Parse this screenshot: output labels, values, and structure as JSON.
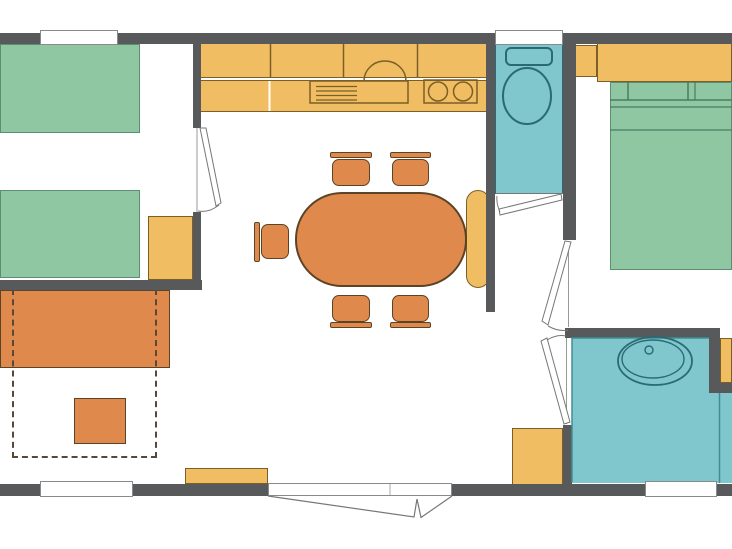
{
  "meta": {
    "title": "mobile-home-floor-plan",
    "canvas": {
      "w": 732,
      "h": 549
    }
  },
  "colors": {
    "background": "#ffffff",
    "wall": "#58595b",
    "window_border": "#8a8a8a",
    "bed_fill": "#8fc7a3",
    "bed_border": "#5d8e74",
    "bed_line": "#4a7b62",
    "water_fill": "#80c6cd",
    "water_border": "#2a6a74",
    "water_line": "#3f8d96",
    "cabinet_fill": "#f0bd62",
    "cabinet_border": "#8a6b2b",
    "cabinet_line": "#7b5f26",
    "orange_fill": "#e0894c",
    "orange_border": "#5b4426",
    "dash_border": "#55493c",
    "door_line": "#777777",
    "door_frame": "#999999"
  },
  "rooms": [
    {
      "name": "twin-bedroom"
    },
    {
      "name": "living-kitchen"
    },
    {
      "name": "wc"
    },
    {
      "name": "master-bedroom"
    },
    {
      "name": "bathroom"
    }
  ],
  "rects": [
    {
      "name": "wc-floor",
      "x": 495,
      "y": 43,
      "w": 68,
      "h": 151,
      "fill": "water_fill",
      "border": "water_border",
      "bw": 1
    },
    {
      "name": "bathroom-floor-main",
      "x": 572,
      "y": 338,
      "w": 137,
      "h": 145,
      "fill": "water_fill"
    },
    {
      "name": "bathroom-floor-right",
      "x": 709,
      "y": 393,
      "w": 23,
      "h": 90,
      "fill": "water_fill"
    },
    {
      "name": "twin-bed-top",
      "x": 0,
      "y": 44,
      "w": 140,
      "h": 89,
      "fill": "bed_fill",
      "border": "bed_border",
      "bw": 1
    },
    {
      "name": "twin-bed-bottom",
      "x": 0,
      "y": 190,
      "w": 140,
      "h": 88,
      "fill": "bed_fill",
      "border": "bed_border",
      "bw": 1
    },
    {
      "name": "double-bed",
      "x": 610,
      "y": 82,
      "w": 122,
      "h": 188,
      "fill": "bed_fill",
      "border": "bed_border",
      "bw": 1
    },
    {
      "name": "kitchen-upper-cabinets",
      "x": 200,
      "y": 43,
      "w": 287,
      "h": 35,
      "fill": "cabinet_fill",
      "border": "cabinet_line",
      "bw": 1
    },
    {
      "name": "kitchen-counter",
      "x": 200,
      "y": 80,
      "w": 287,
      "h": 32,
      "fill": "cabinet_fill",
      "border": "cabinet_line",
      "bw": 1
    },
    {
      "name": "nightstand",
      "x": 148,
      "y": 216,
      "w": 45,
      "h": 64,
      "fill": "cabinet_fill",
      "border": "cabinet_line",
      "bw": 1
    },
    {
      "name": "dining-bench",
      "x": 466,
      "y": 190,
      "w": 24,
      "h": 98,
      "r": 12,
      "fill": "cabinet_fill",
      "border": "cabinet_line",
      "bw": 1
    },
    {
      "name": "wc-side-cabinet",
      "x": 572,
      "y": 45,
      "w": 25,
      "h": 32,
      "fill": "cabinet_fill",
      "border": "cabinet_line",
      "bw": 1
    },
    {
      "name": "bedroom-overhead-cabinet",
      "x": 597,
      "y": 43,
      "w": 135,
      "h": 39,
      "fill": "cabinet_fill",
      "border": "cabinet_line",
      "bw": 1
    },
    {
      "name": "corner-wardrobe",
      "x": 720,
      "y": 338,
      "w": 12,
      "h": 45,
      "fill": "cabinet_fill",
      "border": "cabinet_line",
      "bw": 1
    },
    {
      "name": "entry-shelf",
      "x": 185,
      "y": 468,
      "w": 83,
      "h": 16,
      "fill": "cabinet_fill",
      "border": "cabinet_line",
      "bw": 1
    },
    {
      "name": "bathroom-cabinet",
      "x": 512,
      "y": 428,
      "w": 51,
      "h": 57,
      "fill": "cabinet_fill",
      "border": "cabinet_line",
      "bw": 1
    },
    {
      "name": "dining-table",
      "x": 295,
      "y": 192,
      "w": 172,
      "h": 95,
      "r": 47,
      "fill": "orange_fill",
      "border": "orange_border",
      "bw": 2
    },
    {
      "name": "chair-top-1-back",
      "x": 330,
      "y": 152,
      "w": 42,
      "h": 6,
      "r": 2,
      "fill": "orange_fill",
      "border": "orange_border",
      "bw": 1
    },
    {
      "name": "chair-top-1-seat",
      "x": 332,
      "y": 159,
      "w": 38,
      "h": 27,
      "r": 7,
      "fill": "orange_fill",
      "border": "orange_border",
      "bw": 1
    },
    {
      "name": "chair-top-2-back",
      "x": 390,
      "y": 152,
      "w": 41,
      "h": 6,
      "r": 2,
      "fill": "orange_fill",
      "border": "orange_border",
      "bw": 1
    },
    {
      "name": "chair-top-2-seat",
      "x": 392,
      "y": 159,
      "w": 37,
      "h": 27,
      "r": 7,
      "fill": "orange_fill",
      "border": "orange_border",
      "bw": 1
    },
    {
      "name": "chair-bottom-1-seat",
      "x": 332,
      "y": 295,
      "w": 38,
      "h": 27,
      "r": 7,
      "fill": "orange_fill",
      "border": "orange_border",
      "bw": 1
    },
    {
      "name": "chair-bottom-1-back",
      "x": 330,
      "y": 322,
      "w": 42,
      "h": 6,
      "r": 2,
      "fill": "orange_fill",
      "border": "orange_border",
      "bw": 1
    },
    {
      "name": "chair-bottom-2-seat",
      "x": 392,
      "y": 295,
      "w": 37,
      "h": 27,
      "r": 7,
      "fill": "orange_fill",
      "border": "orange_border",
      "bw": 1
    },
    {
      "name": "chair-bottom-2-back",
      "x": 390,
      "y": 322,
      "w": 41,
      "h": 6,
      "r": 2,
      "fill": "orange_fill",
      "border": "orange_border",
      "bw": 1
    },
    {
      "name": "chair-left-back",
      "x": 254,
      "y": 222,
      "w": 6,
      "h": 40,
      "r": 2,
      "fill": "orange_fill",
      "border": "orange_border",
      "bw": 1
    },
    {
      "name": "chair-left-seat",
      "x": 261,
      "y": 224,
      "w": 28,
      "h": 35,
      "r": 7,
      "fill": "orange_fill",
      "border": "orange_border",
      "bw": 1
    },
    {
      "name": "sofa",
      "x": 0,
      "y": 290,
      "w": 170,
      "h": 78,
      "fill": "orange_fill",
      "border": "orange_border",
      "bw": 1
    },
    {
      "name": "pouf",
      "x": 74,
      "y": 398,
      "w": 52,
      "h": 46,
      "fill": "orange_fill",
      "border": "orange_border",
      "bw": 1
    },
    {
      "name": "sofa-bed-extension",
      "x": 12,
      "y": 289,
      "w": 145,
      "h": 169,
      "border": "dash_border",
      "bw": 2,
      "dash": true
    },
    {
      "name": "wall-top",
      "x": 0,
      "y": 33,
      "w": 732,
      "h": 11,
      "fill": "wall"
    },
    {
      "name": "wall-bottom",
      "x": 0,
      "y": 484,
      "w": 732,
      "h": 12,
      "fill": "wall"
    },
    {
      "name": "wall-twin-bedroom-upper",
      "x": 193,
      "y": 43,
      "w": 8,
      "h": 85,
      "fill": "wall"
    },
    {
      "name": "wall-twin-bedroom-lower",
      "x": 193,
      "y": 212,
      "w": 8,
      "h": 78,
      "fill": "wall"
    },
    {
      "name": "wall-twin-bedroom-bottom",
      "x": 0,
      "y": 280,
      "w": 202,
      "h": 10,
      "fill": "wall"
    },
    {
      "name": "wall-wc-left",
      "x": 486,
      "y": 43,
      "w": 9,
      "h": 269,
      "fill": "wall"
    },
    {
      "name": "wall-wc-right",
      "x": 563,
      "y": 43,
      "w": 13,
      "h": 197,
      "fill": "wall"
    },
    {
      "name": "wall-bathroom-stub",
      "x": 563,
      "y": 425,
      "w": 9,
      "h": 60,
      "fill": "wall"
    },
    {
      "name": "wall-bedroom-bottom",
      "x": 565,
      "y": 328,
      "w": 152,
      "h": 10,
      "fill": "wall"
    },
    {
      "name": "wall-bathroom-corner-v",
      "x": 709,
      "y": 328,
      "w": 11,
      "h": 65,
      "fill": "wall"
    },
    {
      "name": "wall-bathroom-corner-h",
      "x": 717,
      "y": 383,
      "w": 15,
      "h": 10,
      "fill": "wall"
    },
    {
      "name": "window-twin-bedroom",
      "x": 40,
      "y": 30,
      "w": 78,
      "h": 15,
      "fill": "background",
      "border": "window_border",
      "bw": 1
    },
    {
      "name": "window-wc",
      "x": 495,
      "y": 30,
      "w": 68,
      "h": 15,
      "fill": "background",
      "border": "window_border",
      "bw": 1
    },
    {
      "name": "window-living",
      "x": 40,
      "y": 481,
      "w": 93,
      "h": 16,
      "fill": "background",
      "border": "window_border",
      "bw": 1
    },
    {
      "name": "window-bathroom",
      "x": 645,
      "y": 481,
      "w": 72,
      "h": 16,
      "fill": "background",
      "border": "window_border",
      "bw": 1
    },
    {
      "name": "entry-door-opening",
      "x": 268,
      "y": 483,
      "w": 184,
      "h": 13,
      "fill": "background",
      "border": "window_border",
      "bw": 1
    }
  ],
  "svg": [
    {
      "name": "double-bed-sheet-line-1",
      "kind": "line",
      "x1": 610,
      "y1": 100,
      "x2": 732,
      "y2": 100,
      "stroke": "bed_line",
      "sw": 1.5
    },
    {
      "name": "double-bed-sheet-line-2",
      "kind": "line",
      "x1": 610,
      "y1": 107,
      "x2": 732,
      "y2": 107,
      "stroke": "bed_line",
      "sw": 1.2
    },
    {
      "name": "double-bed-fold-line",
      "kind": "line",
      "x1": 610,
      "y1": 130,
      "x2": 732,
      "y2": 130,
      "stroke": "bed_line",
      "sw": 1.2
    },
    {
      "name": "pillow-line-1",
      "kind": "line",
      "x1": 628,
      "y1": 82,
      "x2": 628,
      "y2": 100,
      "stroke": "bed_line",
      "sw": 1.5
    },
    {
      "name": "pillow-line-2",
      "kind": "line",
      "x1": 688,
      "y1": 82,
      "x2": 688,
      "y2": 100,
      "stroke": "bed_line",
      "sw": 1.5
    },
    {
      "name": "pillow-line-3",
      "kind": "line",
      "x1": 695,
      "y1": 82,
      "x2": 695,
      "y2": 100,
      "stroke": "bed_line",
      "sw": 1.2
    },
    {
      "name": "upper-cabinet-divider-1",
      "kind": "line",
      "x1": 270.5,
      "y1": 44,
      "x2": 270.5,
      "y2": 78,
      "stroke": "cabinet_line",
      "sw": 1.5
    },
    {
      "name": "upper-cabinet-divider-2",
      "kind": "line",
      "x1": 343.5,
      "y1": 44,
      "x2": 343.5,
      "y2": 78,
      "stroke": "cabinet_line",
      "sw": 1.5
    },
    {
      "name": "upper-cabinet-divider-3",
      "kind": "line",
      "x1": 417.5,
      "y1": 44,
      "x2": 417.5,
      "y2": 78,
      "stroke": "cabinet_line",
      "sw": 1.5
    },
    {
      "name": "counter-divider",
      "kind": "line",
      "x1": 269.5,
      "y1": 81,
      "x2": 269.5,
      "y2": 111,
      "stroke": "#ffffff",
      "sw": 2
    },
    {
      "name": "sink-unit",
      "kind": "rect",
      "x": 310,
      "y": 81,
      "w": 98,
      "h": 22,
      "fill": "none",
      "stroke": "cabinet_line",
      "sw": 1.5
    },
    {
      "name": "drain-line-1",
      "kind": "line",
      "x1": 316,
      "y1": 86.5,
      "x2": 357,
      "y2": 86.5,
      "stroke": "cabinet_line",
      "sw": 1.2
    },
    {
      "name": "drain-line-2",
      "kind": "line",
      "x1": 316,
      "y1": 91,
      "x2": 357,
      "y2": 91,
      "stroke": "cabinet_line",
      "sw": 1.2
    },
    {
      "name": "drain-line-3",
      "kind": "line",
      "x1": 316,
      "y1": 95.5,
      "x2": 357,
      "y2": 95.5,
      "stroke": "cabinet_line",
      "sw": 1.2
    },
    {
      "name": "drain-line-4",
      "kind": "line",
      "x1": 316,
      "y1": 100,
      "x2": 357,
      "y2": 100,
      "stroke": "cabinet_line",
      "sw": 1.2
    },
    {
      "name": "sink-basin",
      "kind": "path",
      "d": "M364,81 A21,20 0 0 1 406,81",
      "fill": "none",
      "stroke": "cabinet_line",
      "sw": 1.5
    },
    {
      "name": "cooktop",
      "kind": "rect",
      "x": 424,
      "y": 80,
      "w": 53,
      "h": 23,
      "fill": "none",
      "stroke": "cabinet_line",
      "sw": 1.5
    },
    {
      "name": "burner-1",
      "kind": "circle",
      "cx": 438,
      "cy": 91.5,
      "r": 9.5,
      "fill": "none",
      "stroke": "cabinet_line",
      "sw": 1.5
    },
    {
      "name": "burner-2",
      "kind": "circle",
      "cx": 463,
      "cy": 91.5,
      "r": 9.5,
      "fill": "none",
      "stroke": "cabinet_line",
      "sw": 1.5
    },
    {
      "name": "toilet-cistern",
      "kind": "rect",
      "x": 506,
      "y": 48,
      "w": 46,
      "h": 17,
      "rx": 5,
      "fill": "water_fill",
      "stroke": "water_border",
      "sw": 2
    },
    {
      "name": "toilet-bowl",
      "kind": "ellipse",
      "cx": 527,
      "cy": 96,
      "rx": 24,
      "ry": 28,
      "fill": "water_fill",
      "stroke": "water_border",
      "sw": 2
    },
    {
      "name": "bathroom-floor-edge",
      "kind": "path",
      "d": "M572,482 L572,338 L709,338",
      "fill": "none",
      "stroke": "water_line",
      "sw": 1.5
    },
    {
      "name": "bathroom-right-line",
      "kind": "line",
      "x1": 719.5,
      "y1": 393,
      "x2": 719.5,
      "y2": 483,
      "stroke": "water_line",
      "sw": 1.5
    },
    {
      "name": "basin-outer",
      "kind": "ellipse",
      "cx": 655,
      "cy": 361,
      "rx": 37,
      "ry": 24,
      "fill": "none",
      "stroke": "water_border",
      "sw": 1.8
    },
    {
      "name": "basin-inner",
      "kind": "ellipse",
      "cx": 653,
      "cy": 359,
      "rx": 31,
      "ry": 19,
      "fill": "none",
      "stroke": "water_border",
      "sw": 1.4
    },
    {
      "name": "basin-faucet",
      "kind": "circle",
      "cx": 649,
      "cy": 350,
      "r": 4,
      "fill": "none",
      "stroke": "water_border",
      "sw": 1.4
    },
    {
      "name": "twin-bedroom-door-frame",
      "kind": "line",
      "x1": 197,
      "y1": 128,
      "x2": 197,
      "y2": 212,
      "stroke": "door_frame",
      "sw": 1
    },
    {
      "name": "twin-bedroom-door-leaf",
      "kind": "polygon",
      "points": "200,128 206,128 221,203 216,206",
      "fill": "#ffffff",
      "stroke": "door_line",
      "sw": 1
    },
    {
      "name": "twin-bedroom-door-arc",
      "kind": "path",
      "d": "M219,205 Q209,213 198,211",
      "fill": "none",
      "stroke": "door_line",
      "sw": 1
    },
    {
      "name": "wc-door-threshold",
      "kind": "line",
      "x1": 496,
      "y1": 193.5,
      "x2": 563,
      "y2": 193.5,
      "stroke": "door_line",
      "sw": 1
    },
    {
      "name": "wc-door-leaf",
      "kind": "polygon",
      "points": "561,194 562,200 500,215 499,209",
      "fill": "#ffffff",
      "stroke": "door_line",
      "sw": 1
    },
    {
      "name": "wc-door-arc",
      "kind": "path",
      "d": "M500,212 Q496,203 497,196",
      "fill": "none",
      "stroke": "door_line",
      "sw": 1
    },
    {
      "name": "master-bedroom-door-frame",
      "kind": "line",
      "x1": 568.5,
      "y1": 241,
      "x2": 568.5,
      "y2": 327,
      "stroke": "door_frame",
      "sw": 1
    },
    {
      "name": "master-bedroom-door-leaf",
      "kind": "polygon",
      "points": "565,241 571,242 548,325 542,321",
      "fill": "#ffffff",
      "stroke": "door_line",
      "sw": 1
    },
    {
      "name": "master-bedroom-door-arc",
      "kind": "path",
      "d": "M548,326 Q559,332 568,330",
      "fill": "none",
      "stroke": "door_line",
      "sw": 1
    },
    {
      "name": "bathroom-door-frame",
      "kind": "line",
      "x1": 566.5,
      "y1": 338,
      "x2": 566.5,
      "y2": 424,
      "stroke": "door_frame",
      "sw": 1
    },
    {
      "name": "bathroom-door-leaf",
      "kind": "polygon",
      "points": "564,424 570,422 547,338 541,341",
      "fill": "#ffffff",
      "stroke": "door_line",
      "sw": 1
    },
    {
      "name": "bathroom-door-arc",
      "kind": "path",
      "d": "M547,340 Q557,334 566,336",
      "fill": "none",
      "stroke": "door_line",
      "sw": 1
    },
    {
      "name": "entry-door-left-leaf",
      "kind": "path",
      "d": "M268,496 L414,517 L417,499",
      "fill": "none",
      "stroke": "door_line",
      "sw": 1.2
    },
    {
      "name": "entry-door-right-leaf",
      "kind": "path",
      "d": "M452,496 L421,517.5 L417,499",
      "fill": "none",
      "stroke": "door_line",
      "sw": 1.2
    },
    {
      "name": "entry-door-center-line",
      "kind": "line",
      "x1": 390,
      "y1": 484,
      "x2": 390,
      "y2": 495,
      "stroke": "#aaaaaa",
      "sw": 1
    }
  ]
}
